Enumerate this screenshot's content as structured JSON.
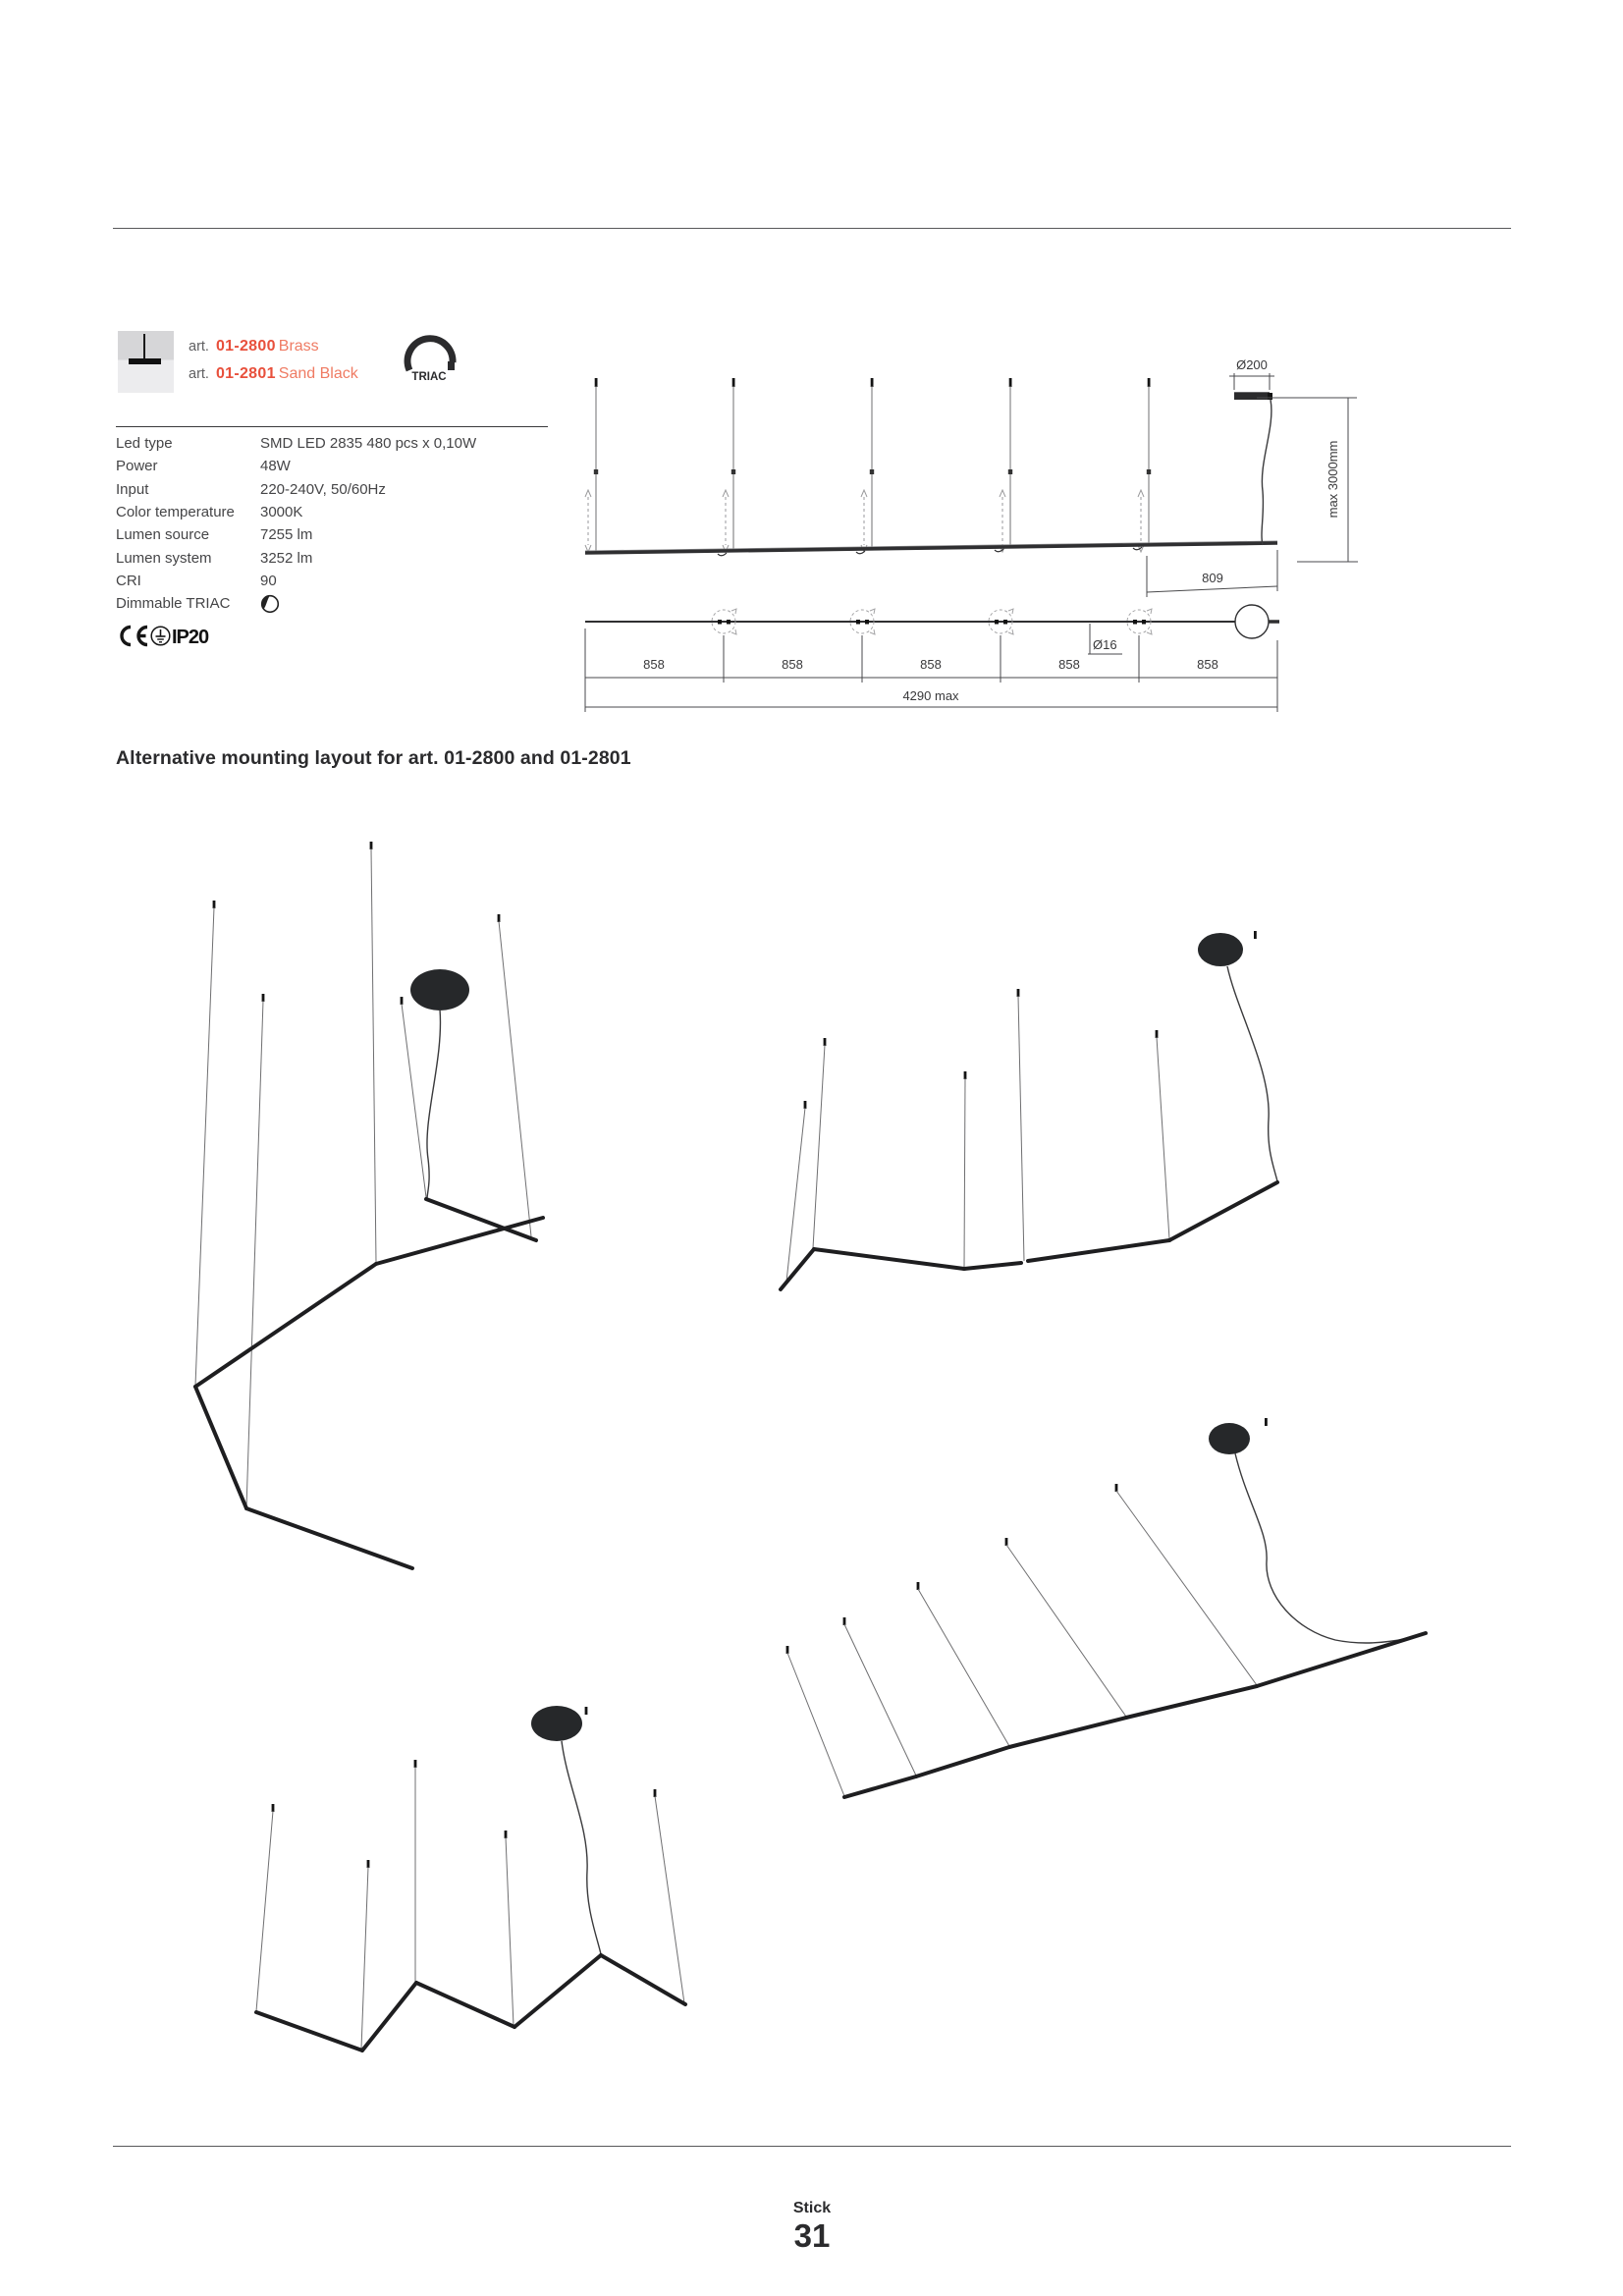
{
  "header": {
    "art_prefix": "art.",
    "items": [
      {
        "code": "01-2800",
        "finish": "Brass"
      },
      {
        "code": "01-2801",
        "finish": "Sand Black"
      }
    ],
    "triac_badge": "TRIAC"
  },
  "specs": {
    "rows": [
      {
        "label": "Led type",
        "value": "SMD LED 2835 480 pcs x 0,10W"
      },
      {
        "label": "Power",
        "value": "48W"
      },
      {
        "label": "Input",
        "value": "220-240V, 50/60Hz"
      },
      {
        "label": "Color temperature",
        "value": "3000K"
      },
      {
        "label": "Lumen source",
        "value": "7255 lm"
      },
      {
        "label": "Lumen system",
        "value": "3252 lm"
      },
      {
        "label": "CRI",
        "value": "90"
      },
      {
        "label": "Dimmable TRIAC",
        "value": ""
      }
    ],
    "certifications": {
      "ce_mark": "CE",
      "ip": "IP20"
    }
  },
  "dimensions": {
    "canopy_diameter": "Ø200",
    "max_drop": "max 3000mm",
    "offset": "809",
    "tube_diameter": "Ø16",
    "segment": "858",
    "total": "4290 max"
  },
  "section": {
    "heading": "Alternative mounting layout for  art. 01-2800 and 01-2801"
  },
  "footer": {
    "product_name": "Stick",
    "page_number": "31"
  },
  "colors": {
    "accent_red": "#e8503c",
    "accent_red_light": "#ef7b63",
    "ink": "#2b2b2d",
    "text_gray": "#454547"
  }
}
